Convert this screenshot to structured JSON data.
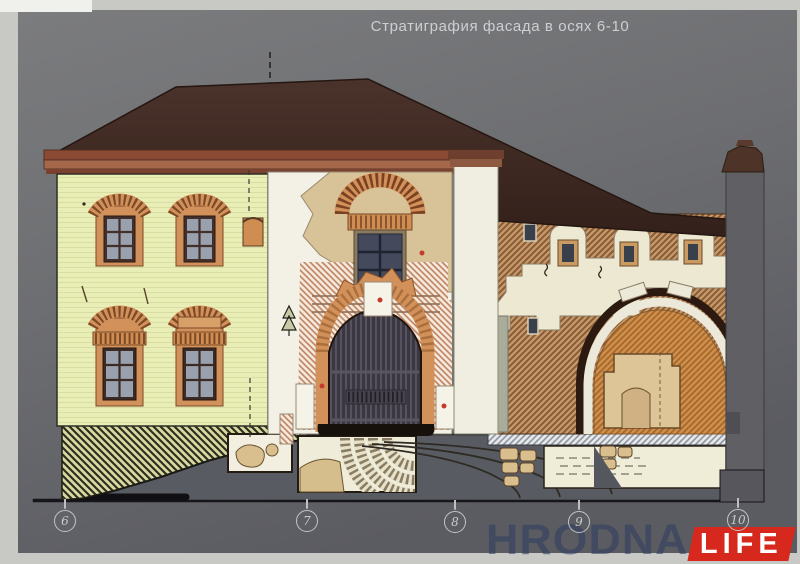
{
  "slide": {
    "title": "Стратиграфия фасада  в осях 6-10"
  },
  "axes": [
    {
      "label": "6"
    },
    {
      "label": "7"
    },
    {
      "label": "8"
    },
    {
      "label": "9"
    },
    {
      "label": "10"
    }
  ],
  "watermark": {
    "name": "HRODNA",
    "life": "LIFE"
  },
  "palette": {
    "screen_border": "#c8c8c4",
    "slide_background": "#6e6f72",
    "roof_brown": "#402b21",
    "cornice_terracotta": "#8d5a41",
    "facade_yellow": "#e9edb6",
    "window_surround_orange": "#d2915a",
    "wall_white": "#f3f1e6",
    "wall_tan": "#d8c297",
    "brick_hatch_brown": "#c59a6b",
    "arch_fill_orange": "#d0914d",
    "gate_metal_gray": "#3b3742",
    "ground_gray": "#595b63",
    "sample_dot_red": "#c43b2a",
    "watermark_red": "#d6281c",
    "watermark_blue": "#3a4a6a"
  }
}
